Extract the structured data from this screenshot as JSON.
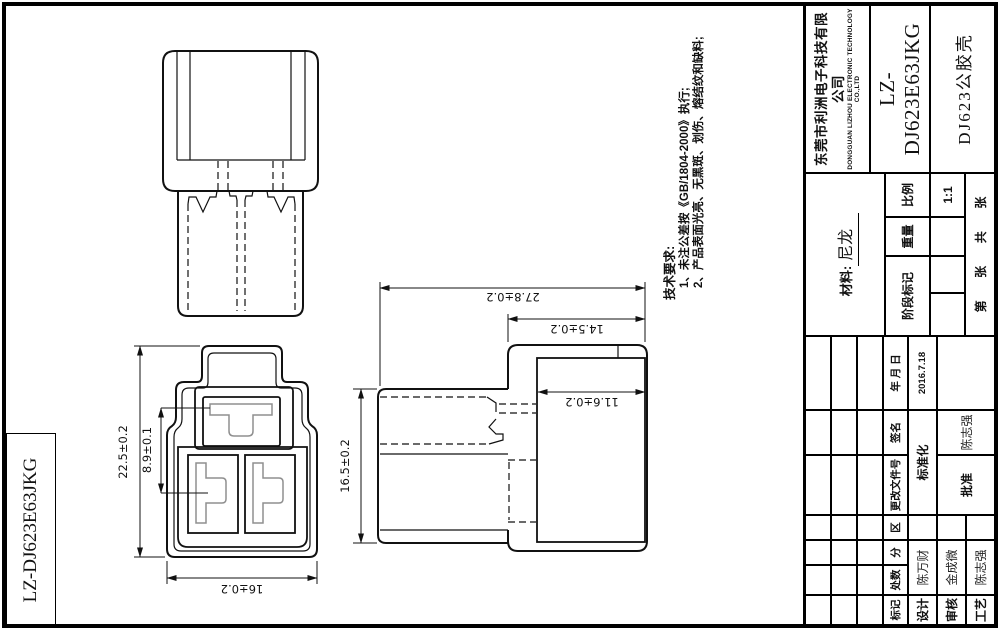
{
  "dims": {
    "front_height": "22.5±0.2",
    "pin_pitch": "8.9±0.1",
    "front_width": "16±0.2",
    "side_height": "16.5±0.2",
    "total_length": "27.8±0.2",
    "head_length": "14.5±0.2",
    "inner_width": "11.6±0.2"
  },
  "tech_requirements": {
    "title": "技术要求:",
    "item1": "1、未注公差按《GB/1804-2000》执行;",
    "item2": "2、产品表面光亮、无黑斑、划伤、熔结纹和缺料;"
  },
  "side_box": {
    "part_code": "LZ-DJ623E63JKG"
  },
  "title_block": {
    "company_cn": "东莞市利洲电子科技有限公司",
    "company_en": "DONGGUAN LIZHOU ELECTRONIC TECHNOLOGY CO.,LTD",
    "part_code": "LZ-DJ623E63JKG",
    "part_name": "DJ623公胶壳",
    "material_label": "材料:",
    "material_value": "尼龙",
    "stage_label": "阶段标记",
    "weight_label": "重量",
    "scale_label": "比例",
    "scale_value": "1:1",
    "sheet_words": [
      "第",
      "张",
      "共",
      "张"
    ],
    "rev_headers": [
      "标记",
      "处数",
      "分",
      "区",
      "更改文件号",
      "签名",
      "年 月 日"
    ],
    "rows": {
      "design_label": "设计",
      "design_name": "陈万财",
      "date": "2016.7.18",
      "standard_label": "标准化",
      "check_label": "审核",
      "check_name": "金成微",
      "approve_label": "批准",
      "approve_name": "陈志强",
      "process_label": "工艺",
      "process_name": "陈志强"
    }
  }
}
